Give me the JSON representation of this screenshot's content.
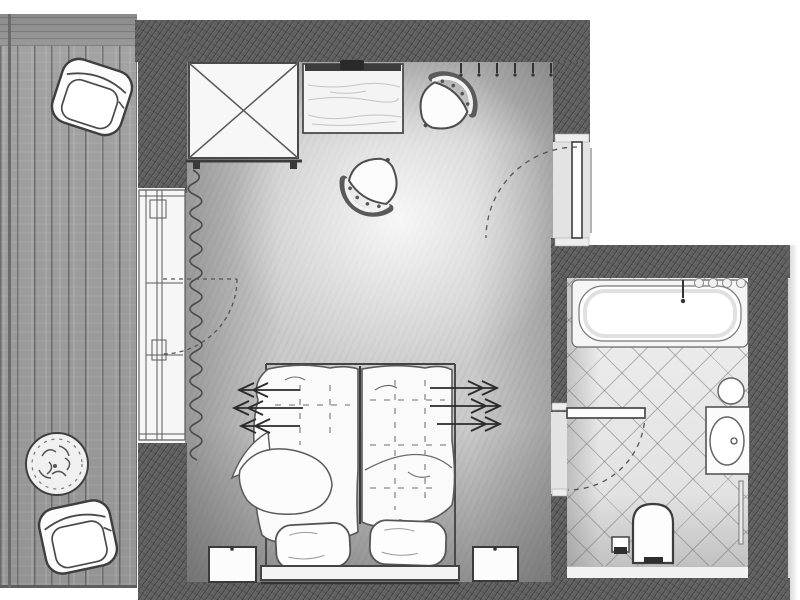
{
  "app": {
    "type": "architectural-floor-plan",
    "subject": "hotel guest room plan with bedroom, en-suite bathroom and balcony",
    "canvas": {
      "width": 800,
      "height": 600
    },
    "visible_text": "none"
  },
  "palette": {
    "wall": "#616161",
    "floor": "#cbcbcb",
    "deck": "#949494",
    "tile": "#dedede",
    "tile_line": "rgba(130,130,130,0.55)",
    "ink": "#3f3f3f",
    "furniture_fill": "#fafafa"
  },
  "rooms": [
    {
      "id": "bedroom",
      "floor_finish": "carpet",
      "furniture": [
        "wardrobe",
        "desk",
        "tv-ledge",
        "desk-chair-1",
        "desk-chair-2",
        "double-bed",
        "pillow-left",
        "pillow-right",
        "nightstand-left",
        "nightstand-right",
        "curtain"
      ]
    },
    {
      "id": "bathroom",
      "floor_finish": "diagonal-tile",
      "furniture": [
        "bathtub",
        "tub-faucet",
        "washbasin-vanity",
        "toilet",
        "flush-panel",
        "towel-rail",
        "wall-accessory"
      ]
    },
    {
      "id": "balcony",
      "floor_finish": "wood-plank",
      "furniture": [
        "armchair-north",
        "armchair-south",
        "potted-plant"
      ]
    }
  ],
  "doors": [
    {
      "id": "entrance-door",
      "between": [
        "exterior",
        "bedroom"
      ],
      "leaf": "solid",
      "swing_arc": "dashed"
    },
    {
      "id": "bathroom-door",
      "between": [
        "bedroom",
        "bathroom"
      ],
      "leaf": "solid",
      "swing_arc": "dashed"
    },
    {
      "id": "balcony-door",
      "between": [
        "bedroom",
        "balcony"
      ],
      "leaf": "dashed",
      "swing_arc": "dashed",
      "part_of": "window-wall"
    }
  ],
  "annotations": {
    "bed_arrow_group_left": {
      "count": 3,
      "direction": "left"
    },
    "bed_arrow_group_right": {
      "count": 3,
      "direction": "right"
    },
    "wall_hook_ticks": {
      "count": 6,
      "location": "top-wall-near-entrance"
    },
    "tub_edge_bumps": {
      "count": 4
    }
  }
}
